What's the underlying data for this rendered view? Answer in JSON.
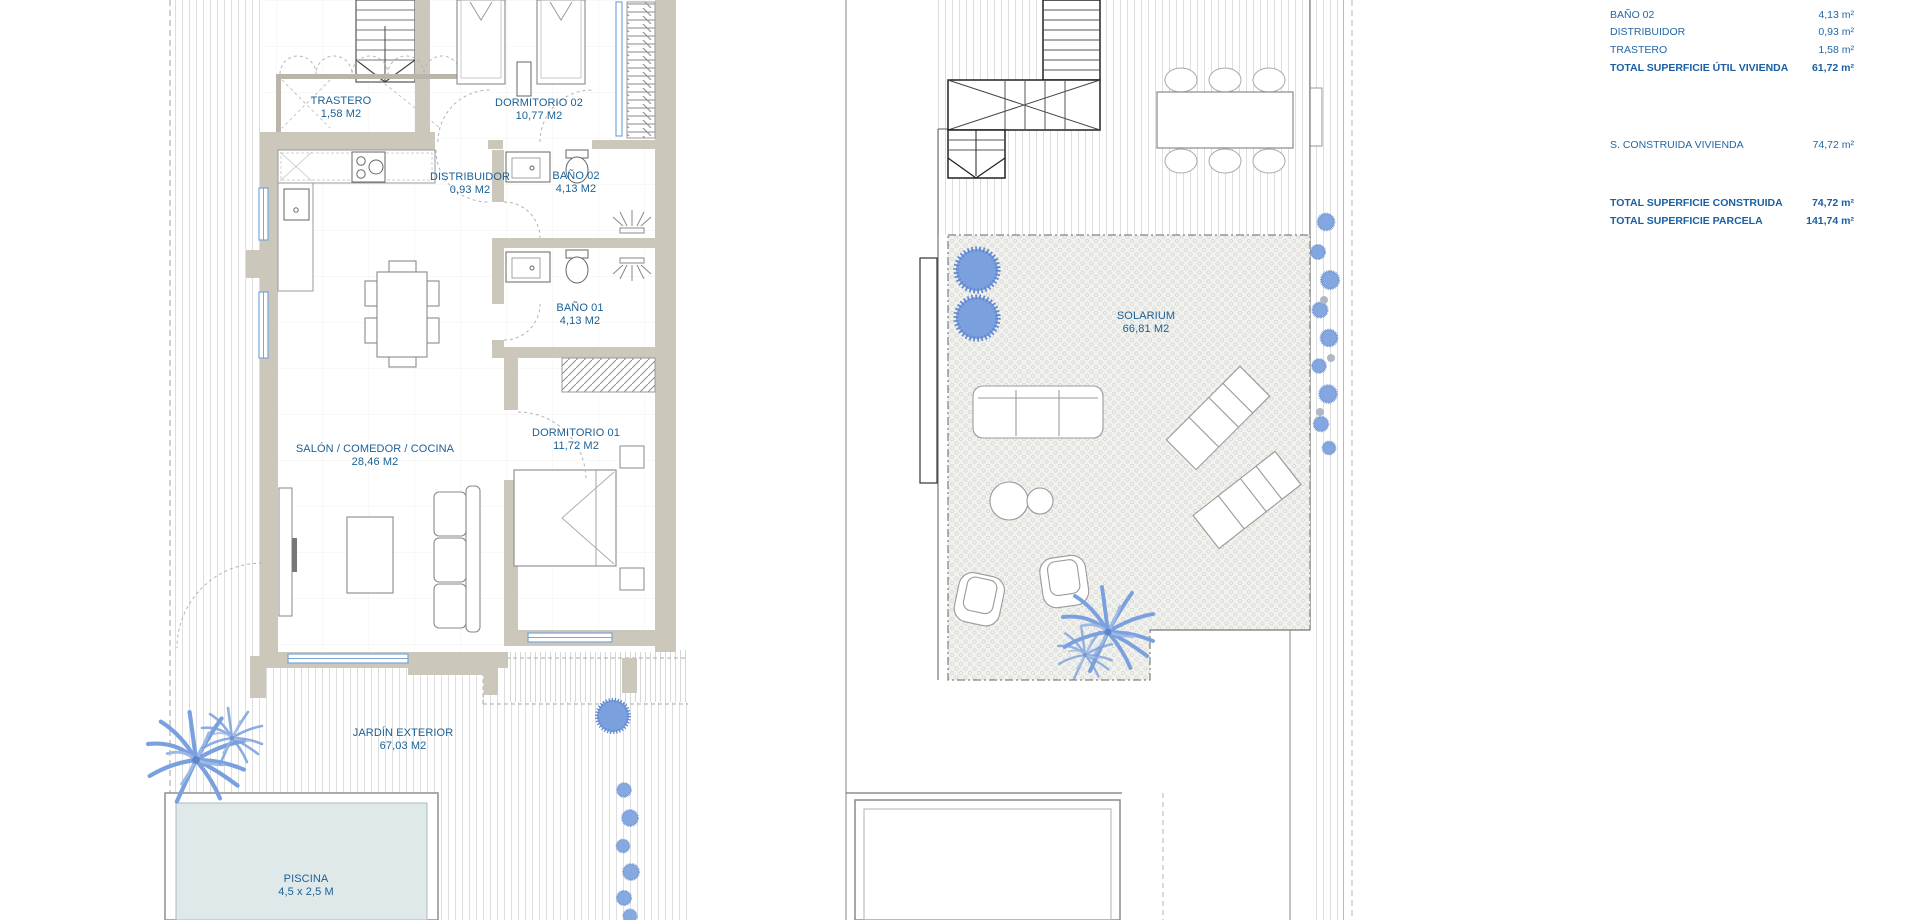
{
  "left_plan": {
    "rooms": [
      {
        "name": "TRASTERO",
        "area": "1,58 M2"
      },
      {
        "name": "DORMITORIO 02",
        "area": "10,77 M2"
      },
      {
        "name": "DISTRIBUIDOR",
        "area": "0,93 M2"
      },
      {
        "name": "BAÑO 02",
        "area": "4,13 M2"
      },
      {
        "name": "BAÑO 01",
        "area": "4,13 M2"
      },
      {
        "name": "SALÓN / COMEDOR / COCINA",
        "area": "28,46 M2"
      },
      {
        "name": "DORMITORIO 01",
        "area": "11,72 M2"
      },
      {
        "name": "JARDÍN EXTERIOR",
        "area": "67,03 M2"
      },
      {
        "name": "PISCINA",
        "area": "4,5 x 2,5 M"
      }
    ]
  },
  "right_plan": {
    "rooms": [
      {
        "name": "SOLARIUM",
        "area": "66,81 M2"
      }
    ]
  },
  "summary_table": {
    "rows": [
      {
        "label": "BAÑO 02",
        "value": "4,13 m²",
        "bold": false
      },
      {
        "label": "DISTRIBUIDOR",
        "value": "0,93 m²",
        "bold": false
      },
      {
        "label": "TRASTERO",
        "value": "1,58 m²",
        "bold": false
      },
      {
        "label": "TOTAL SUPERFICIE ÚTIL VIVIENDA",
        "value": "61,72 m²",
        "bold": true
      },
      {
        "label": "S. CONSTRUIDA VIVIENDA",
        "value": "74,72 m²",
        "bold": false
      },
      {
        "label": "TOTAL SUPERFICIE CONSTRUIDA",
        "value": "74,72 m²",
        "bold": true
      },
      {
        "label": "TOTAL SUPERFICIE PARCELA",
        "value": "141,74 m²",
        "bold": true
      }
    ]
  },
  "colors": {
    "wall": "#cbc7ba",
    "label_blue": "#1c6196",
    "table_blue": "#2267a7",
    "plant_blue": "#7aa0de",
    "pool_water": "#e0e9e9",
    "window_blue": "#7aa7d8"
  }
}
